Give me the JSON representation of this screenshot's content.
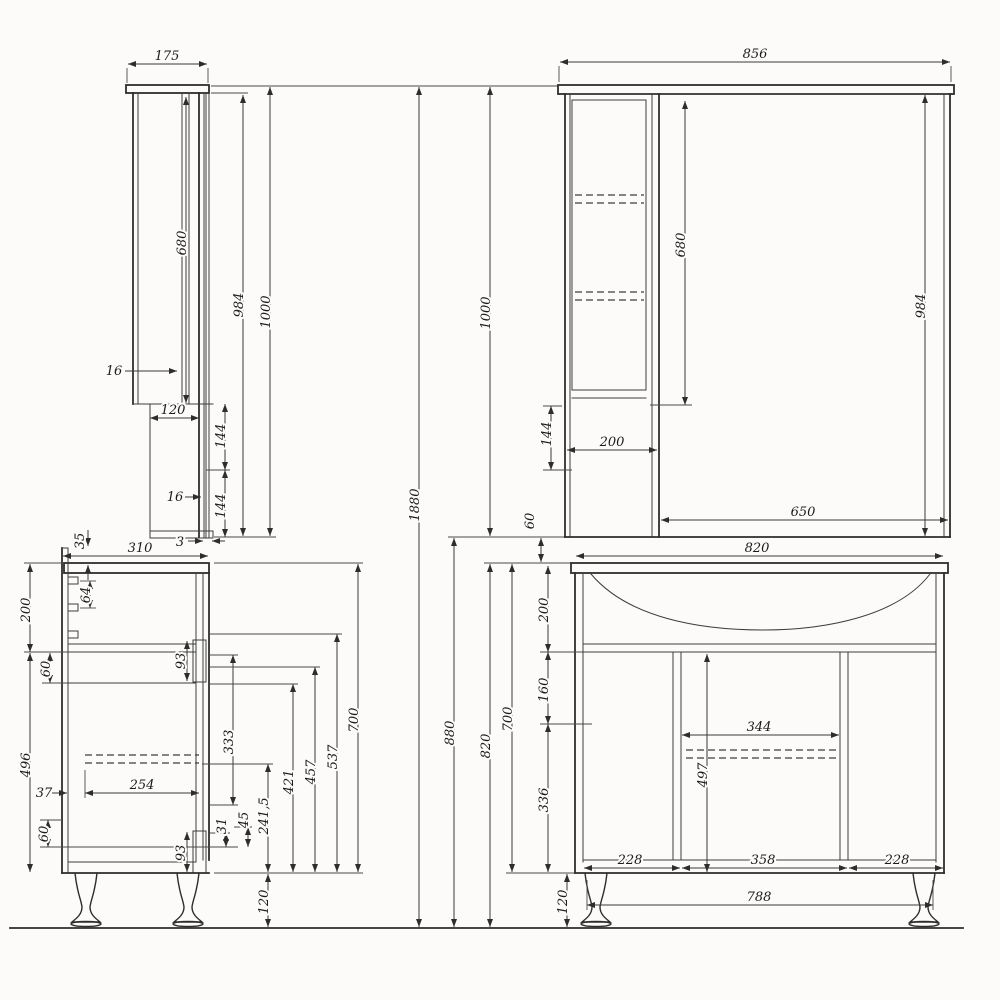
{
  "drawing": {
    "units": "mm",
    "overall_total_height": "1880",
    "views": {
      "mirror_side": {
        "title": "mirror cabinet side view",
        "dims": {
          "depth": "175",
          "opening": "680",
          "h984": "984",
          "height": "1000",
          "back16": "16",
          "lower_depth": "120",
          "upper144": "144",
          "front16": "16",
          "lower144": "144",
          "mirror3": "3"
        }
      },
      "mirror_front": {
        "title": "mirror cabinet front view",
        "dims": {
          "width": "856",
          "height": "1000",
          "total": "1880",
          "opening": "680",
          "h984": "984",
          "h144": "144",
          "column": "200",
          "mirror": "650",
          "gap": "60"
        }
      },
      "vanity_side": {
        "title": "vanity base side view",
        "dims": {
          "top35": "35",
          "depth": "310",
          "p64": "64",
          "top200": "200",
          "g60a": "60",
          "h496": "496",
          "d37": "37",
          "d254": "254",
          "g60b": "60",
          "h93a": "93",
          "h333": "333",
          "h93b": "93",
          "h31": "31",
          "h45": "45",
          "h241": "241,5",
          "leg120": "120",
          "h421": "421",
          "h457": "457",
          "h537": "537",
          "h700": "700"
        }
      },
      "vanity_front": {
        "title": "vanity base front view",
        "dims": {
          "width": "820",
          "total880": "880",
          "total820": "820",
          "h700": "700",
          "top200": "200",
          "h160": "160",
          "h336": "336",
          "w344": "344",
          "h497": "497",
          "door228l": "228",
          "w358": "358",
          "door228r": "228",
          "w788": "788",
          "leg120": "120"
        }
      }
    }
  }
}
